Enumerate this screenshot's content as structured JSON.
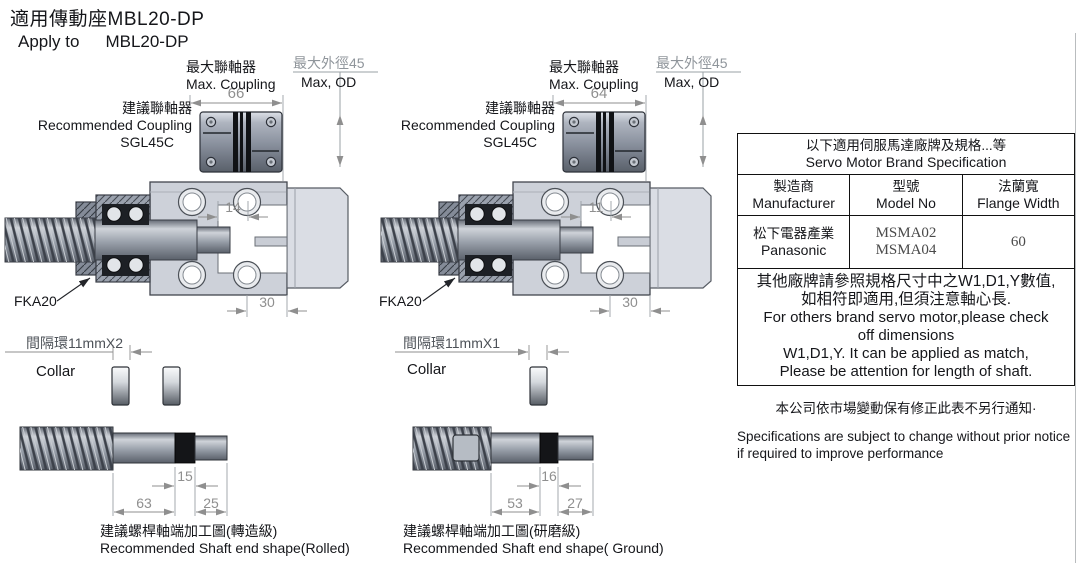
{
  "page": {
    "title_zh": "適用傳動座MBL20-DP",
    "title_en_prefix": "Apply to",
    "title_en_model": "MBL20-DP"
  },
  "views": {
    "left": {
      "recommended_coupling_zh": "建議聯軸器",
      "recommended_coupling_en": "Recommended Coupling",
      "recommended_coupling_model": "SGL45C",
      "max_coupling_zh": "最大聯軸器",
      "max_coupling_en": "Max. Coupling",
      "max_od_zh": "最大外徑45",
      "max_od_en": "Max, OD",
      "coupling_width": "66",
      "shaft_inset": "14",
      "pilot_depth": "30",
      "support_unit": "FKA20"
    },
    "right": {
      "recommended_coupling_zh": "建議聯軸器",
      "recommended_coupling_en": "Recommended Coupling",
      "recommended_coupling_model": "SGL45C",
      "max_coupling_zh": "最大聯軸器",
      "max_coupling_en": "Max. Coupling",
      "max_od_zh": "最大外徑45",
      "max_od_en": "Max, OD",
      "coupling_width": "64",
      "shaft_inset": "11",
      "pilot_depth": "30",
      "support_unit": "FKA20"
    }
  },
  "shafts": {
    "rolled": {
      "spacer_label": "間隔環11mmX2",
      "collar_label": "Collar",
      "dim_band": "15",
      "dim_body": "63",
      "dim_end": "25",
      "caption_zh": "建議螺桿軸端加工圖(轉造級)",
      "caption_en": "Recommended Shaft end shape(Rolled)"
    },
    "ground": {
      "spacer_label": "間隔環11mmX1",
      "collar_label": "Collar",
      "dim_band": "16",
      "dim_body": "53",
      "dim_end": "27",
      "caption_zh": "建議螺桿軸端加工圖(研磨級)",
      "caption_en": "Recommended Shaft end shape( Ground)"
    }
  },
  "spec_table": {
    "title_zh": "以下適用伺服馬達廠牌及規格...等",
    "title_en": "Servo Motor Brand Specification",
    "col_manufacturer_zh": "製造商",
    "col_manufacturer_en": "Manufacturer",
    "col_model_zh": "型號",
    "col_model_en": "Model No",
    "col_flange_zh": "法蘭寬",
    "col_flange_en": "Flange Width",
    "row": {
      "manufacturer_zh": "松下電器產業",
      "manufacturer_en": "Panasonic",
      "model_1": "MSMA02",
      "model_2": "MSMA04",
      "flange_width": "60"
    },
    "note_line1": "其他廠牌請參照規格尺寸中之W1,D1,Y數值,",
    "note_line2": "如相符即適用,但須注意軸心長.",
    "note_line3": "For others brand servo motor,please check",
    "note_line4": "off dimensions",
    "note_line5": "W1,D1,Y. It can be applied as match,",
    "note_line6": "Please be attention for length of shaft."
  },
  "footer": {
    "notice_zh": "本公司依市場變動保有修正此表不另行通知·",
    "notice_en_line1": "Specifications are subject to change without prior notice",
    "notice_en_line2": "if required to improve performance"
  }
}
